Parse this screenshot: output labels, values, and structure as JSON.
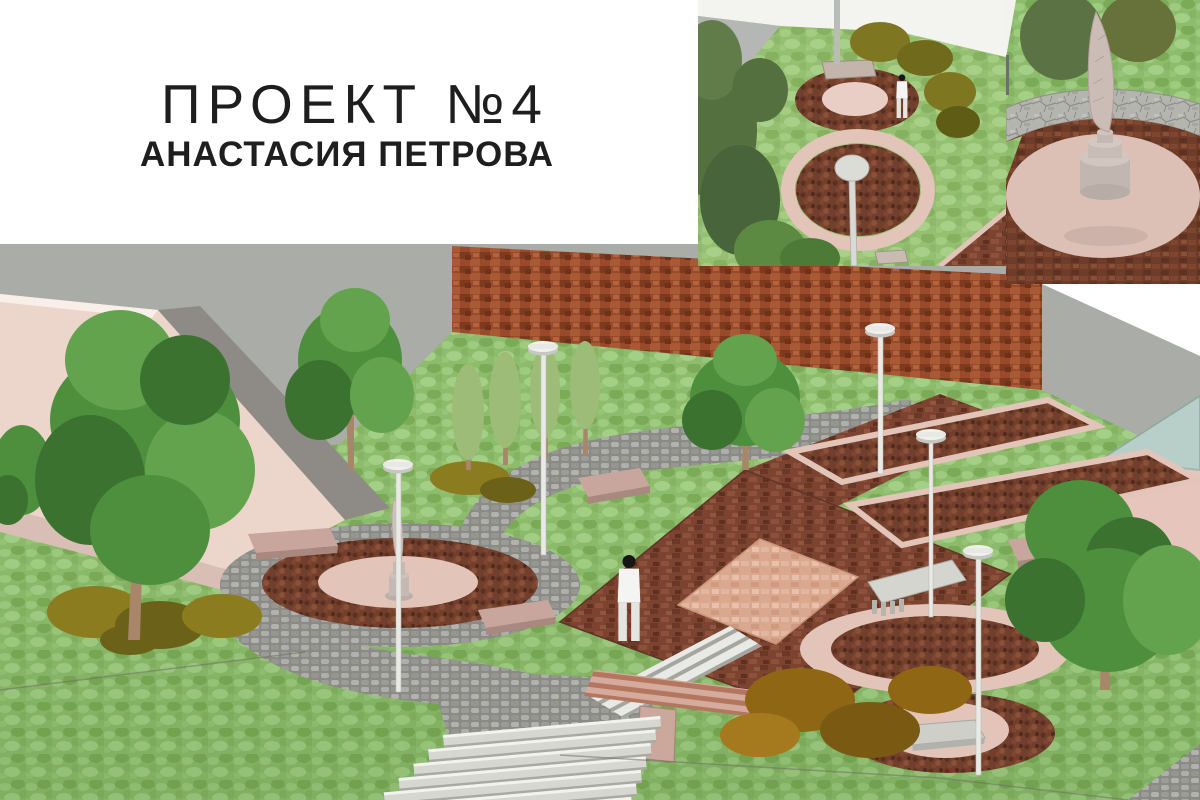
{
  "slide": {
    "title": "ПРОЕКТ №4",
    "subtitle": "АНАСТАСИЯ ПЕТРОВА"
  },
  "panels": [
    {
      "name": "main-park-plaza-render"
    },
    {
      "name": "aerial-planters-view"
    },
    {
      "name": "quill-inkwell-monument-closeup"
    }
  ],
  "palette": {
    "background": "#ffffff",
    "title_text": "#1e1e1e",
    "wall_gray": "#a9aca7",
    "brick_red": "#9a4a2b",
    "plaza_brick": "#7c4330",
    "mulch_brown": "#723f2d",
    "paver_dark": "#6f3c2a",
    "grass_green": "#8dbc6d",
    "cobble_gray": "#8a8a86",
    "stone_step": "#d7d7d1",
    "pink_ring": "#e2c4b8",
    "salmon_square": "#d9a88e",
    "building_pink": "#ecd5cb",
    "ramp_gray": "#8e8b87",
    "glass_teal": "#b7cfc8",
    "pavilion_pink": "#e6c6bc",
    "bench_pink": "#c8a69d",
    "lamp_white": "#f0f0ec",
    "pole_gray": "#e9e9e6",
    "tree_green": "#4e8f3e",
    "tree_light": "#63a34d",
    "tree_dark": "#3c7230",
    "tree_pale": "#9dbc77",
    "olive_shrub": "#8a7c1f",
    "olive_dark": "#6b6118",
    "autumn_shrub": "#8f6714",
    "trunk_brown": "#a8866a",
    "sculpture_stone": "#c9bcb4"
  }
}
